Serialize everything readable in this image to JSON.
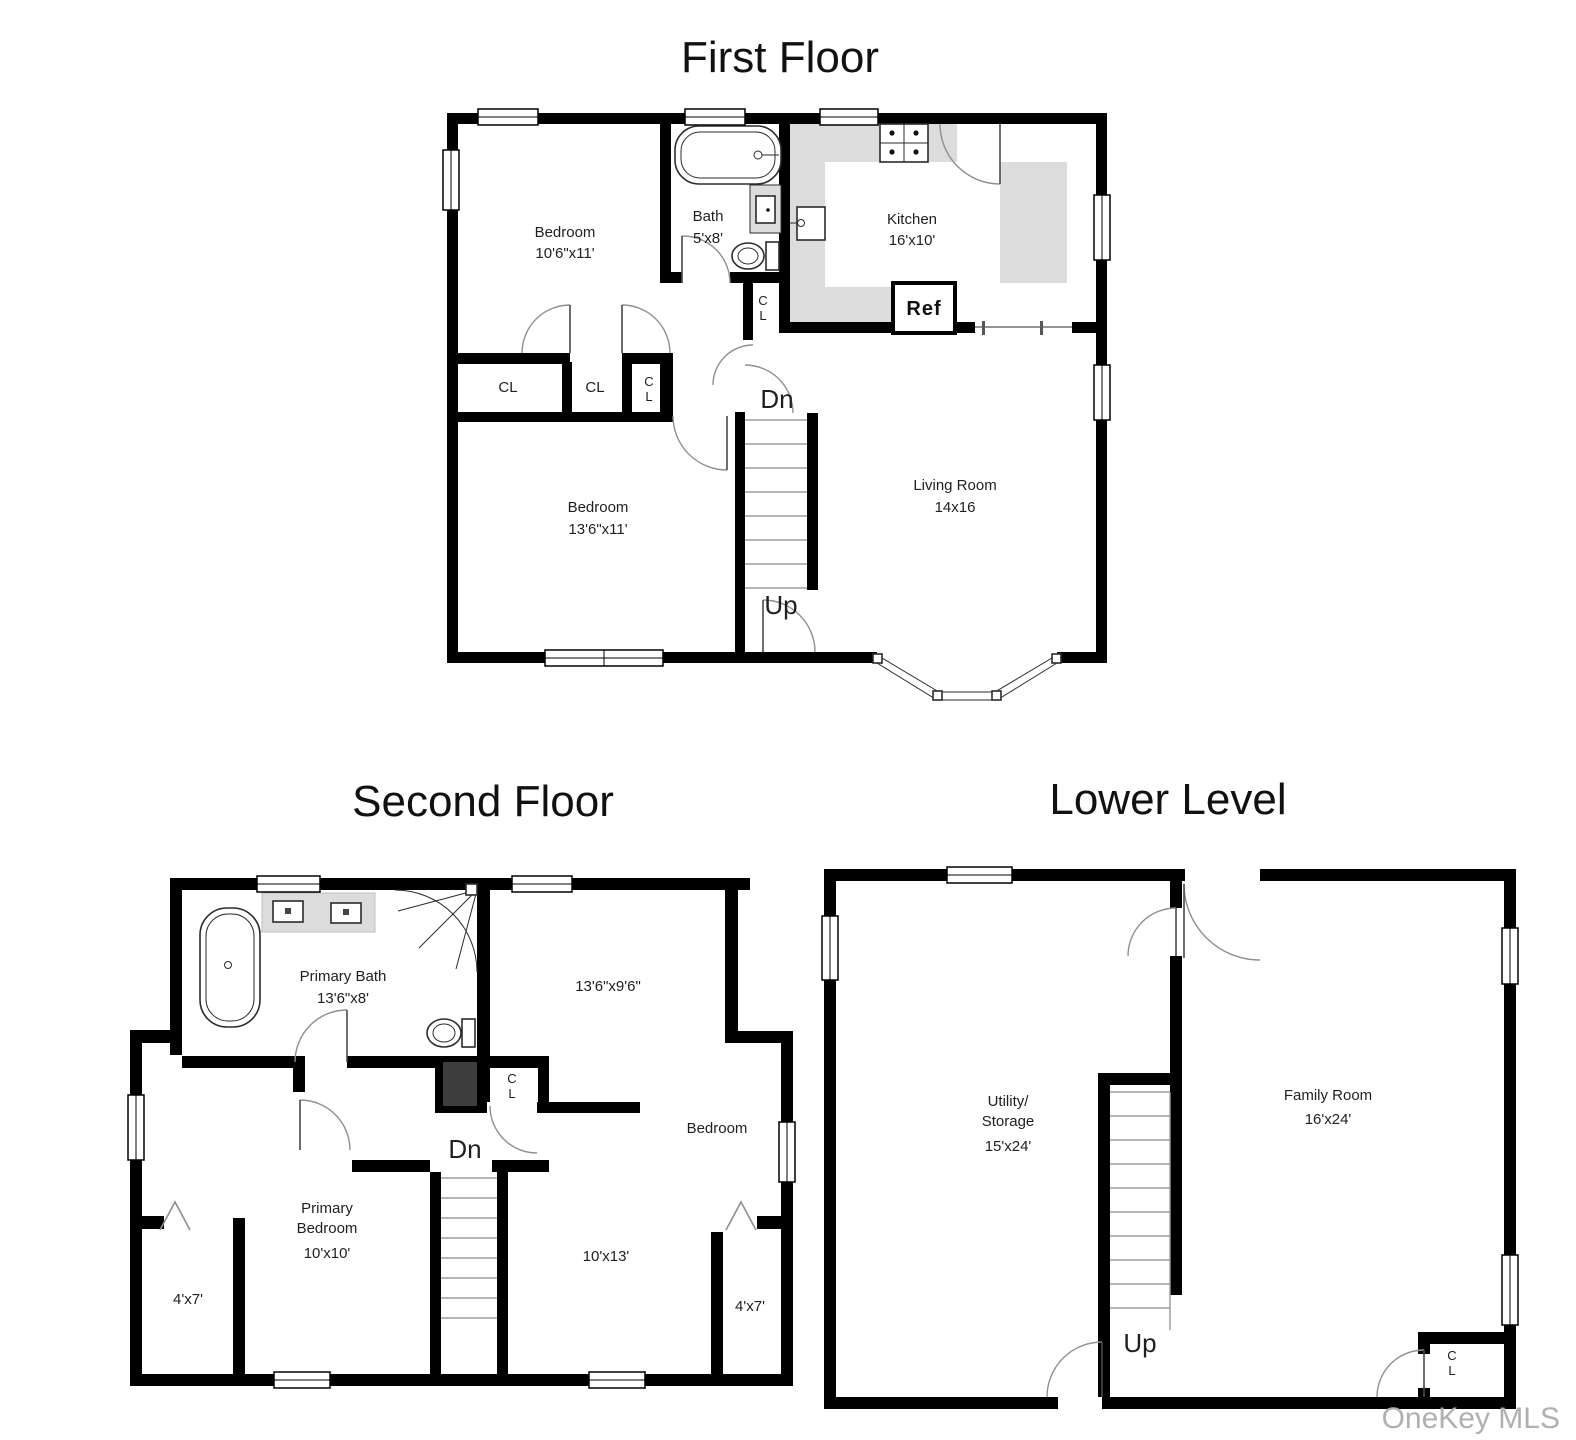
{
  "watermark": "OneKey MLS",
  "colors": {
    "wall": "#000000",
    "counter_gray": "#dcdcdc",
    "dark_closet": "#3d3d3d",
    "text": "#1f1f1f",
    "door_arc": "#8f8f8f",
    "watermark_gray": "#b0b0b0"
  },
  "first_floor": {
    "title": "First Floor",
    "rooms": {
      "bedroom1": {
        "name": "Bedroom",
        "dims": "10'6\"x11'"
      },
      "bath": {
        "name": "Bath",
        "dims": "5'x8'"
      },
      "kitchen": {
        "name": "Kitchen",
        "dims": "16'x10'"
      },
      "bedroom2": {
        "name": "Bedroom",
        "dims": "13'6\"x11'"
      },
      "living": {
        "name": "Living Room",
        "dims": "14x16"
      }
    },
    "labels": {
      "ref": "Ref",
      "cl_left": "CL",
      "cl_mid": "CL",
      "cl_small_c": "C",
      "cl_small_l": "L",
      "cl_kitchen_c": "C",
      "cl_kitchen_l": "L",
      "dn": "Dn",
      "up": "Up"
    }
  },
  "second_floor": {
    "title": "Second Floor",
    "rooms": {
      "primary_bath": {
        "name": "Primary Bath",
        "dims": "13'6\"x8'"
      },
      "room_top_right": {
        "dims": "13'6\"x9'6\""
      },
      "bedroom": {
        "name": "Bedroom",
        "dims": "10'x13'"
      },
      "primary_bedroom": {
        "name1": "Primary",
        "name2": "Bedroom",
        "dims": "10'x10'"
      },
      "closet_left": {
        "dims": "4'x7'"
      },
      "closet_right": {
        "dims": "4'x7'"
      }
    },
    "labels": {
      "cl_c": "C",
      "cl_l": "L",
      "dn": "Dn"
    }
  },
  "lower_level": {
    "title": "Lower Level",
    "rooms": {
      "utility": {
        "name1": "Utility/",
        "name2": "Storage",
        "dims": "15'x24'"
      },
      "family": {
        "name": "Family Room",
        "dims": "16'x24'"
      }
    },
    "labels": {
      "up": "Up",
      "cl_c": "C",
      "cl_l": "L"
    }
  }
}
